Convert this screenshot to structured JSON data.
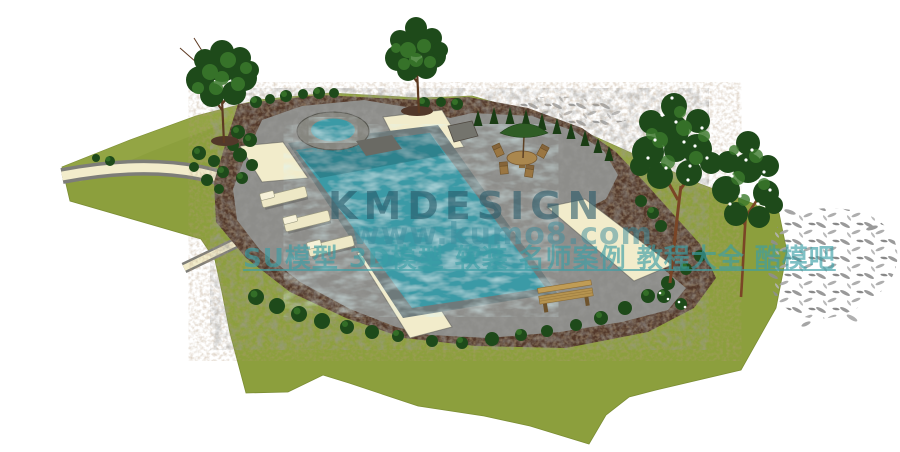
{
  "watermark": {
    "brand": "KMDESIGN",
    "url": "www.kumo8.com",
    "tagline": "SU模型 3D模型 软装 名师案例 教程大全 酷模吧"
  },
  "palette": {
    "lawn": "#8c9f3d",
    "berm": "#9aab4b",
    "water": "#3b9aa6",
    "coping": "#6e7a7b",
    "deck": "#8d8d8a",
    "cream": "#f2eccb",
    "mulch": "#52382a",
    "treeDark": "#1e4a1a",
    "treeLight": "#3b7a2c",
    "cone": "#1a3d14",
    "trunk": "#6b4226",
    "wood": "#b5934f",
    "umbrella": "#2f5d25",
    "wmBrand": "rgba(42,90,105,0.60)",
    "wmUrl": "rgba(64,142,158,0.52)",
    "wmTagline": "rgba(58,158,166,0.65)"
  }
}
